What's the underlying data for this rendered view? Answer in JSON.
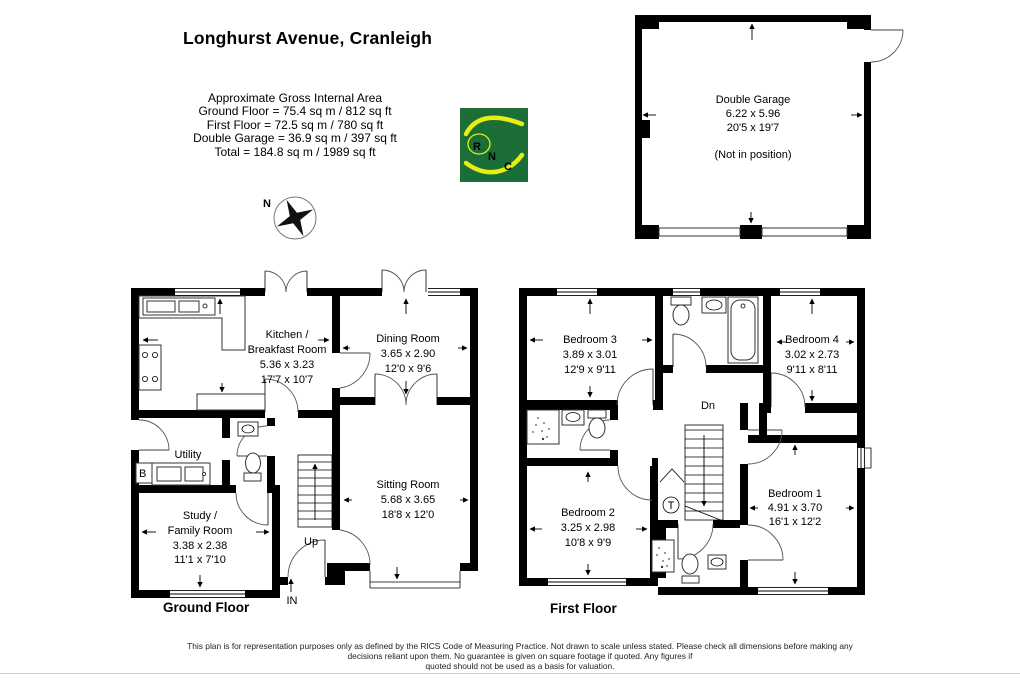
{
  "title": "Longhurst Avenue, Cranleigh",
  "area_summary": {
    "heading": "Approximate Gross Internal Area",
    "lines": [
      "Ground Floor = 75.4 sq m / 812 sq ft",
      "First Floor = 72.5 sq m / 780 sq ft",
      "Double Garage = 36.9 sq m / 397 sq ft",
      "Total = 184.8 sq m / 1989 sq ft"
    ]
  },
  "logo": {
    "l1": "R",
    "l2": "N",
    "l3": "C"
  },
  "compass": {
    "north_label": "N"
  },
  "floors": {
    "ground_label": "Ground Floor",
    "first_label": "First Floor"
  },
  "garage": {
    "name": "Double Garage",
    "metric": "6.22 x 5.96",
    "imperial": "20'5 x 19'7",
    "note": "(Not in position)"
  },
  "rooms": {
    "kitchen": {
      "name1": "Kitchen /",
      "name2": "Breakfast Room",
      "metric": "5.36 x 3.23",
      "imperial": "17'7 x 10'7"
    },
    "dining": {
      "name": "Dining Room",
      "metric": "3.65 x 2.90",
      "imperial": "12'0 x 9'6"
    },
    "sitting": {
      "name": "Sitting Room",
      "metric": "5.68 x 3.65",
      "imperial": "18'8 x 12'0"
    },
    "study": {
      "name1": "Study /",
      "name2": "Family Room",
      "metric": "3.38 x 2.38",
      "imperial": "11'1 x 7'10"
    },
    "utility": {
      "name": "Utility"
    },
    "bedroom1": {
      "name": "Bedroom 1",
      "metric": "4.91 x 3.70",
      "imperial": "16'1 x 12'2"
    },
    "bedroom2": {
      "name": "Bedroom 2",
      "metric": "3.25 x 2.98",
      "imperial": "10'8 x 9'9"
    },
    "bedroom3": {
      "name": "Bedroom 3",
      "metric": "3.89 x 3.01",
      "imperial": "12'9 x 9'11"
    },
    "bedroom4": {
      "name": "Bedroom 4",
      "metric": "3.02 x 2.73",
      "imperial": "9'11 x 8'11"
    }
  },
  "annotations": {
    "up": "Up",
    "down": "Dn",
    "entrance": "IN",
    "boiler": "B",
    "tank": "T"
  },
  "colors": {
    "wall": "#000000",
    "logo_green": "#1b6e38",
    "logo_yellow": "#e6ee12"
  },
  "footer": {
    "line1": "This plan is for representation purposes only as defined by the RICS Code of Measuring Practice. Not drawn to scale unless stated. Please check all dimensions before making any",
    "line2": "decisions reliant upon them. No guarantee is given on square footage if quoted. Any figures if",
    "line3": "quoted should not be used as a basis for valuation."
  }
}
